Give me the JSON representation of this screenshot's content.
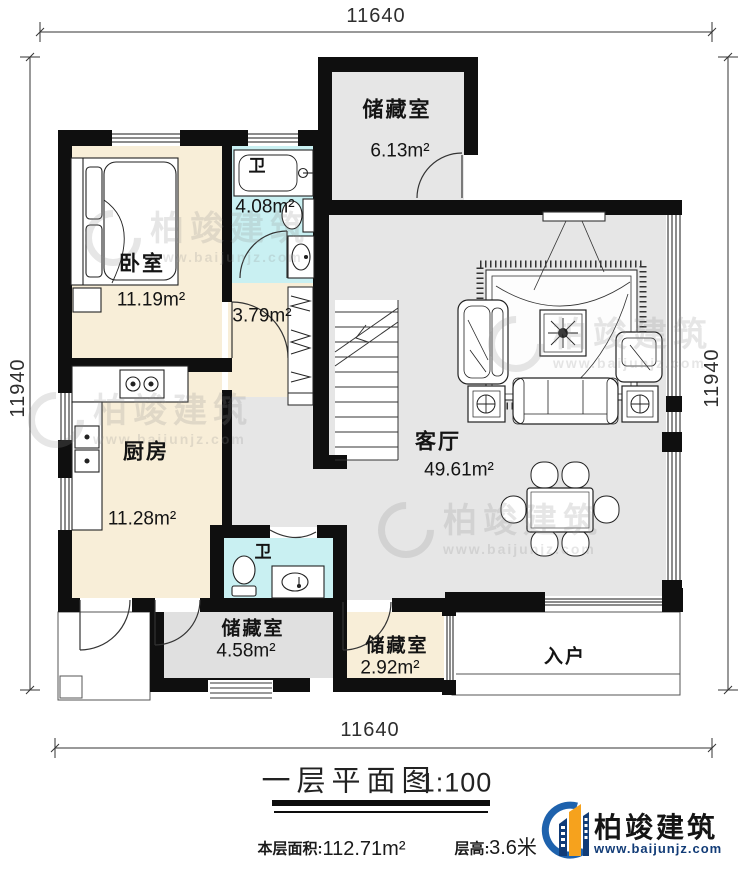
{
  "document": {
    "title": "一层平面图",
    "scale": "1:100",
    "footer": {
      "area_label": "本层面积:",
      "area_value": "112.71m²",
      "floor_height_label": "层高:",
      "floor_height_value": "3.6米"
    }
  },
  "dimensions": {
    "top": "11640",
    "bottom": "11640",
    "left": "11940",
    "right": "11940"
  },
  "rooms": {
    "storage_top": {
      "name": "储藏室",
      "area": "6.13m²"
    },
    "bedroom": {
      "name": "卧室",
      "area": "11.19m²"
    },
    "bath_top": {
      "name": "卫",
      "area": "4.08m²"
    },
    "hallway": {
      "area": "3.79m²"
    },
    "kitchen": {
      "name": "厨房",
      "area": "11.28m²"
    },
    "living": {
      "name": "客厅",
      "area": "49.61m²"
    },
    "bath_bottom": {
      "name": "卫"
    },
    "storage_mid": {
      "name": "储藏室",
      "area": "4.58m²"
    },
    "storage_small": {
      "name": "储藏室",
      "area": "2.92m²"
    },
    "entry": {
      "name": "入户"
    }
  },
  "branding": {
    "logo_text": "柏竣建筑",
    "logo_url": "www.baijunjz.com",
    "watermark_text": "柏竣建筑",
    "watermark_url": "www.baijunjz.com"
  },
  "colors": {
    "wall": "#0f0f0f",
    "room_cream": "#f8eed8",
    "room_cyan": "#c9f0f2",
    "room_gray": "#e6e6e6",
    "logo_blue": "#1e62ad",
    "logo_orange": "#f6a21d",
    "logo_navy": "#123c77"
  }
}
